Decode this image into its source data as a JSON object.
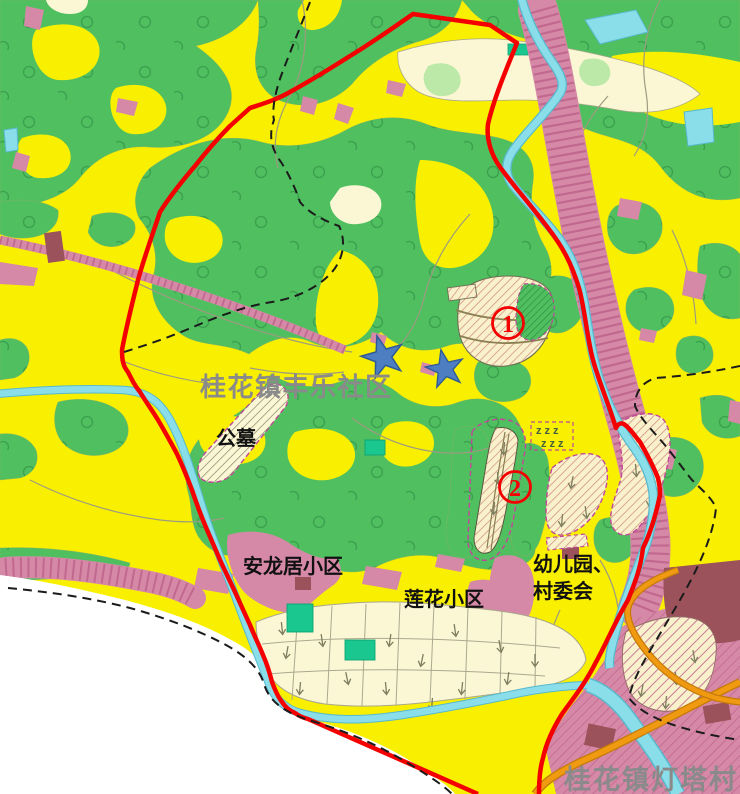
{
  "map": {
    "region_labels": {
      "community": {
        "text": "桂花镇丰乐社区"
      },
      "cemetery": {
        "text": "公墓"
      },
      "anlongju": {
        "text": "安龙居小区"
      },
      "lianhua": {
        "text": "莲花小区"
      },
      "kindergarten_line1": {
        "text": "幼儿园、"
      },
      "kindergarten_line2": {
        "text": "村委会"
      },
      "village_bottom": {
        "text": "桂花镇灯塔村"
      }
    },
    "markers": {
      "site1": {
        "number": "1"
      },
      "site2": {
        "number": "2"
      },
      "stars": {
        "count": 2
      },
      "marsh_symbol": {
        "text": "zzz"
      }
    },
    "palette": {
      "farmland_yellow": "#F8F000",
      "forest_green": "#50BF60",
      "settlement_pink": "#D689A7",
      "water_cyan": "#8ADEE9",
      "boundary_red": "#F40000",
      "development_cream": "#F8F1CB",
      "paddy_cream": "#FBF7D5",
      "building_maroon": "#9C525B",
      "road_orange": "#E8930E",
      "gray_label": "#8A8A8A"
    }
  }
}
